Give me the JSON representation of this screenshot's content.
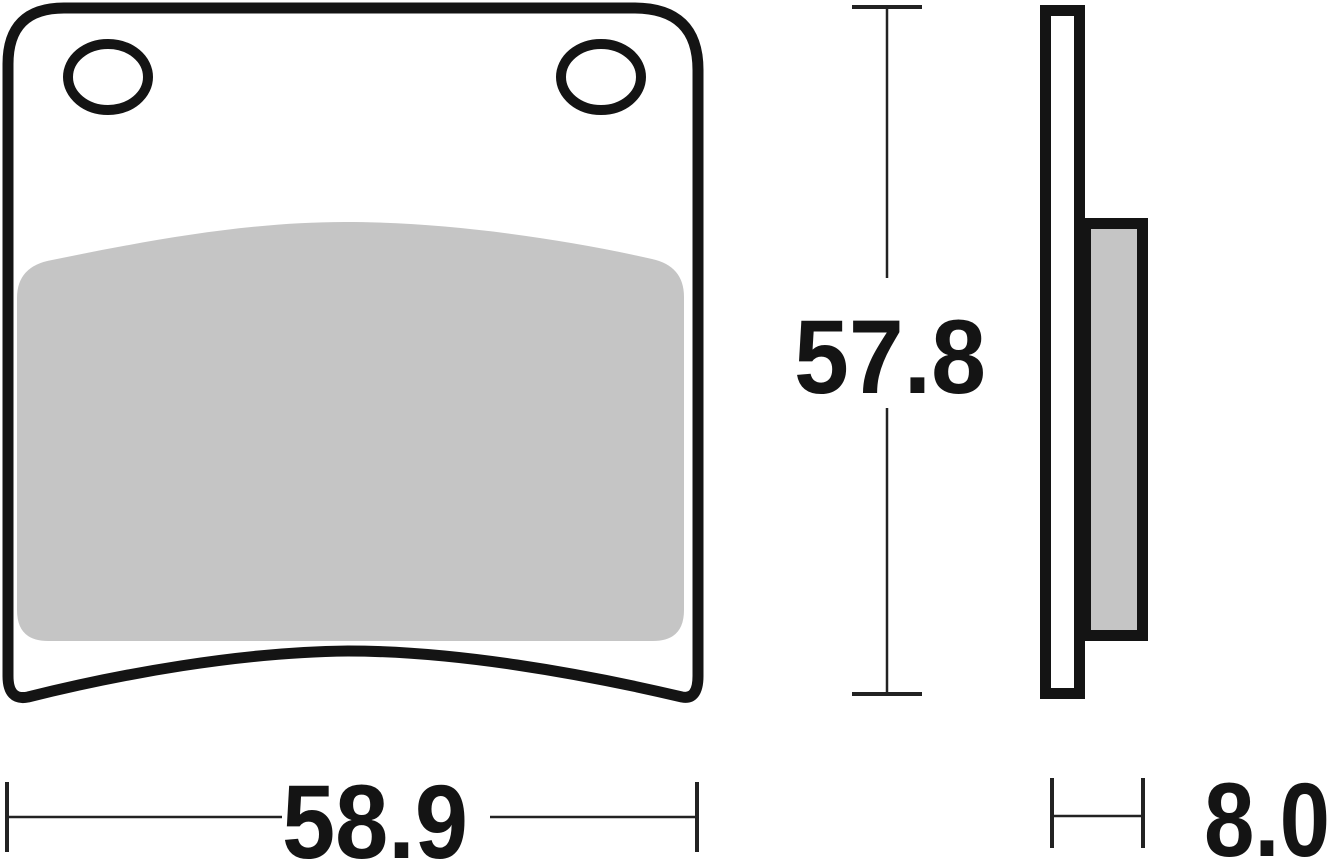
{
  "diagram": {
    "kind": "brake-pad-technical-drawing",
    "dimensions": {
      "height": {
        "value": "57.8"
      },
      "width": {
        "value": "58.9"
      },
      "thickness": {
        "value": "8.0"
      }
    },
    "colors": {
      "line": "#141414",
      "dim-line": "#222222",
      "friction-gray": "#c5c5c5",
      "background": "#ffffff"
    }
  }
}
